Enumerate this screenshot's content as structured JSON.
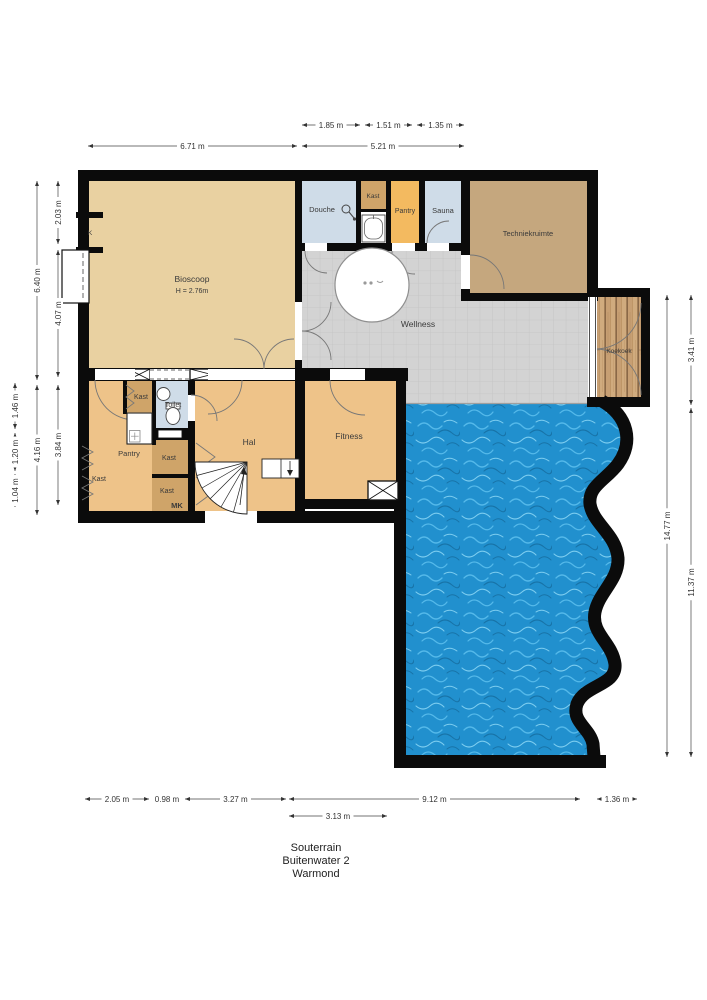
{
  "title": {
    "line1": "Souterrain",
    "line2": "Buitenwater 2",
    "line3": "Warmond"
  },
  "rooms": {
    "bioscoop": {
      "label": "Bioscoop",
      "ceiling_height": "H = 2.76m"
    },
    "douche": {
      "label": "Douche"
    },
    "kast_boven": {
      "label": "Kast"
    },
    "pantry_boven": {
      "label": "Pantry"
    },
    "sauna": {
      "label": "Sauna"
    },
    "techniekruimte": {
      "label": "Techniekruimte"
    },
    "wellness": {
      "label": "Wellness"
    },
    "koekoek": {
      "label": "Koekoek"
    },
    "k": {
      "label": "K"
    },
    "kast_a": {
      "label": "Kast"
    },
    "toilet": {
      "label": "Toilet"
    },
    "pantry": {
      "label": "Pantry"
    },
    "kast_links": {
      "label": "Kast"
    },
    "kast_midden": {
      "label": "Kast"
    },
    "kast_onder": {
      "label": "Kast"
    },
    "mk": {
      "label": "MK"
    },
    "hal": {
      "label": "Hal"
    },
    "fitness": {
      "label": "Fitness"
    }
  },
  "dimensions": {
    "entries": [
      {
        "label": "1.85 m",
        "x1": 302,
        "y1": 125,
        "x2": 360,
        "y2": 125
      },
      {
        "label": "1.51 m",
        "x1": 365,
        "y1": 125,
        "x2": 412,
        "y2": 125
      },
      {
        "label": "1.35 m",
        "x1": 417,
        "y1": 125,
        "x2": 464,
        "y2": 125
      },
      {
        "label": "6.71 m",
        "x1": 88,
        "y1": 146,
        "x2": 297,
        "y2": 146
      },
      {
        "label": "5.21 m",
        "x1": 302,
        "y1": 146,
        "x2": 464,
        "y2": 146
      },
      {
        "label": "2.03 m",
        "x1": 58,
        "y1": 181,
        "x2": 58,
        "y2": 244
      },
      {
        "label": "4.07 m",
        "x1": 58,
        "y1": 250,
        "x2": 58,
        "y2": 377
      },
      {
        "label": "3.84 m",
        "x1": 58,
        "y1": 385,
        "x2": 58,
        "y2": 505
      },
      {
        "label": "6.40 m",
        "x1": 37,
        "y1": 181,
        "x2": 37,
        "y2": 380
      },
      {
        "label": "4.16 m",
        "x1": 37,
        "y1": 385,
        "x2": 37,
        "y2": 515
      },
      {
        "label": "1.46 m",
        "x1": 15,
        "y1": 383,
        "x2": 15,
        "y2": 429
      },
      {
        "label": "1.20 m",
        "x1": 15,
        "y1": 433,
        "x2": 15,
        "y2": 471
      },
      {
        "label": "1.04 m",
        "x1": 15,
        "y1": 474,
        "x2": 15,
        "y2": 507
      },
      {
        "label": "14.77 m",
        "x1": 667,
        "y1": 295,
        "x2": 667,
        "y2": 757
      },
      {
        "label": "3.41 m",
        "x1": 691,
        "y1": 295,
        "x2": 691,
        "y2": 405
      },
      {
        "label": "11.37 m",
        "x1": 691,
        "y1": 408,
        "x2": 691,
        "y2": 757
      },
      {
        "label": "2.05 m",
        "x1": 85,
        "y1": 799,
        "x2": 149,
        "y2": 799
      },
      {
        "label": "0.98 m",
        "x1": 152,
        "y1": 799,
        "x2": 182,
        "y2": 799
      },
      {
        "label": "3.27 m",
        "x1": 185,
        "y1": 799,
        "x2": 286,
        "y2": 799
      },
      {
        "label": "9.12 m",
        "x1": 289,
        "y1": 799,
        "x2": 580,
        "y2": 799
      },
      {
        "label": "1.36 m",
        "x1": 597,
        "y1": 799,
        "x2": 637,
        "y2": 799
      },
      {
        "label": "3.13 m",
        "x1": 289,
        "y1": 816,
        "x2": 387,
        "y2": 816
      }
    ]
  },
  "colors": {
    "wall": "#0b0b0b",
    "tan": "#e9d1a1",
    "tan2": "#eec389",
    "brown": "#cfa469",
    "orange": "#f3ba60",
    "blue": "#cfdce8",
    "taupe": "#c5a77e",
    "water": "#2190ce",
    "wood": "#c79f73",
    "tile": "#d3d3d3"
  }
}
